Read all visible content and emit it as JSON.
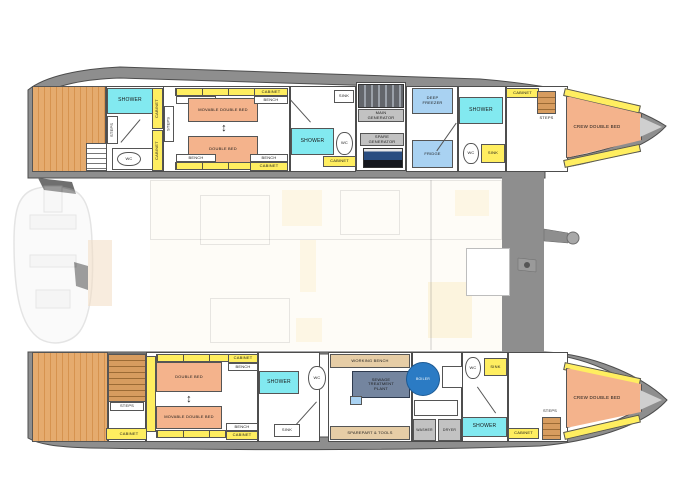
{
  "rooms": {
    "shower": "SHOWER",
    "wc": "WC",
    "sink": "SINK",
    "cabinet": "CABINET",
    "bench": "BENCH",
    "steps": "STEPS",
    "double_bed": "DOUBLE BED",
    "movable_double_bed": "MOVABLE DOUBLE BED",
    "crew_double_bed": "CREW DOUBLE BED",
    "main_generator": "MAIN GENERATOR",
    "spare_generator": "SPARE GENERATOR",
    "deep_freezer": "DEEP FREEZER",
    "fridge": "FRIDGE",
    "working_bench": "WORKING BENCH",
    "sewage_treatment_plant": "SEWAGE TREATMENT PLANT",
    "sparepart_tools": "SPAREPART & TOOLS",
    "washer": "WASHER",
    "dryer": "DRYER",
    "boiler": "BOILER",
    "move_arrow": "↕"
  },
  "colors": {
    "bed": "#f4b38c",
    "cabinet": "#ffee60",
    "shower": "#82e9f0",
    "appliance": "#a9d2f2",
    "machine": "#c2c2c2",
    "sewage": "#74859f",
    "boiler": "#2b7bc4",
    "workbench": "#e6cda6",
    "hull": "#8e8e8e"
  }
}
